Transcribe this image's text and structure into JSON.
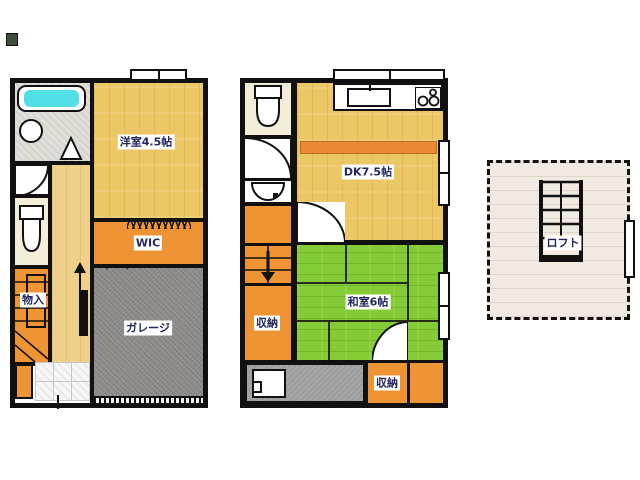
{
  "document_type": "floor-plan",
  "plan_1f": {
    "rooms": {
      "western_room": "洋室4.5帖",
      "wic": "WIC",
      "garage": "ガレージ",
      "storage": "物入"
    },
    "fixtures": [
      "bathtub",
      "washbasin",
      "toilet",
      "stairs-up",
      "entrance-tiles",
      "garage-shutter",
      "window"
    ]
  },
  "plan_2f": {
    "rooms": {
      "dk": "DK7.5帖",
      "japanese_room": "和室6帖",
      "storage_side": "収納",
      "storage_bottom": "収納"
    },
    "fixtures": [
      "toilet",
      "washbasin",
      "kitchen-sink",
      "gas-stove",
      "counter",
      "stairs-down",
      "balcony",
      "washing-machine",
      "windows"
    ]
  },
  "loft": {
    "label": "ロフト",
    "fixtures": [
      "ladder",
      "window"
    ]
  },
  "colors": {
    "wall": "#111111",
    "wood_floor": "#ecc766",
    "closet_orange": "#ef9435",
    "garage_gray": "#8e8c8a",
    "balcony_gray": "#9c9c9c",
    "tatami_green": "#84cb35",
    "bathtub_cyan": "#52dfe6",
    "toilet_cream": "#f2eed8",
    "loft_floor": "#f1eae1",
    "label_text": "#20265e"
  }
}
